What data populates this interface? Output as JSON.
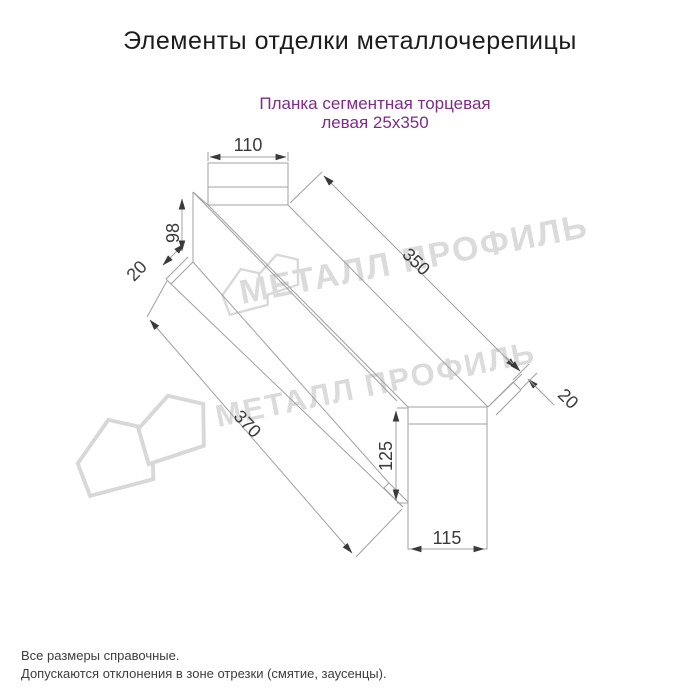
{
  "page": {
    "title": "Элементы отделки металлочерепицы",
    "subtitle_line1": "Планка сегментная торцевая",
    "subtitle_line2": "левая 25х350",
    "subtitle_color": "#7d2b87",
    "background_color": "#ffffff"
  },
  "drawing": {
    "type": "isometric technical line drawing of left segmental end strip",
    "line_color": "#a0a0a0",
    "dim_text_color": "#3a3a3a",
    "dimensions": {
      "top_width": "110",
      "left_height": "98",
      "left_hem": "20",
      "length_top": "350",
      "right_hem": "20",
      "length_bottom": "370",
      "right_height": "125",
      "bottom_width": "115"
    }
  },
  "watermark": {
    "text": "МЕТАЛЛ ПРОФИЛЬ",
    "color": "#dbdbdb"
  },
  "footer": {
    "note1": "Все размеры справочные.",
    "note2": "Допускаются отклонения в зоне отрезки (смятие, заусенцы)."
  }
}
